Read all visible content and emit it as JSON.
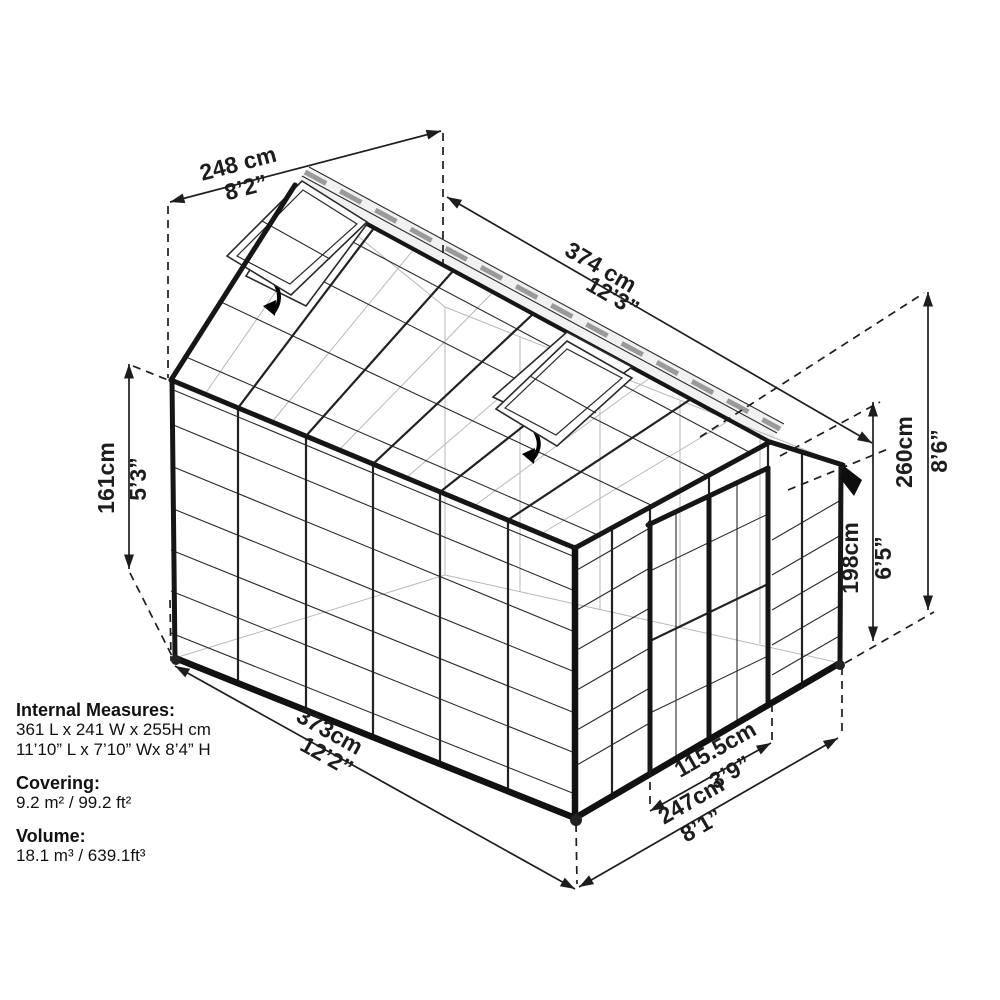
{
  "colors": {
    "line": "#1d1d1d",
    "background": "#ffffff"
  },
  "dims": {
    "width_top": {
      "cm": "248 cm",
      "ft": "8’2”"
    },
    "length_top": {
      "cm": "374 cm",
      "ft": "12’3”"
    },
    "wall_height": {
      "cm": "161cm",
      "ft": "5’3”"
    },
    "total_height": {
      "cm": "260cm",
      "ft": "8’6”"
    },
    "door_height": {
      "cm": "198cm",
      "ft": "6’5”"
    },
    "length_bottom": {
      "cm": "373cm",
      "ft": "12’2”"
    },
    "door_width": {
      "cm": "115.5cm",
      "ft": "3’9”"
    },
    "width_bottom": {
      "cm": "247cm",
      "ft": "8’1”"
    }
  },
  "specs": {
    "internal_label": "Internal Measures:",
    "internal_metric": "361 L x 241 W x 255H cm",
    "internal_imperial": "11’10” L x 7’10” Wx 8’4” H",
    "covering_label": "Covering:",
    "covering_value": "9.2 m² / 99.2 ft²",
    "volume_label": "Volume:",
    "volume_value": "18.1 m³ / 639.1ft³"
  }
}
